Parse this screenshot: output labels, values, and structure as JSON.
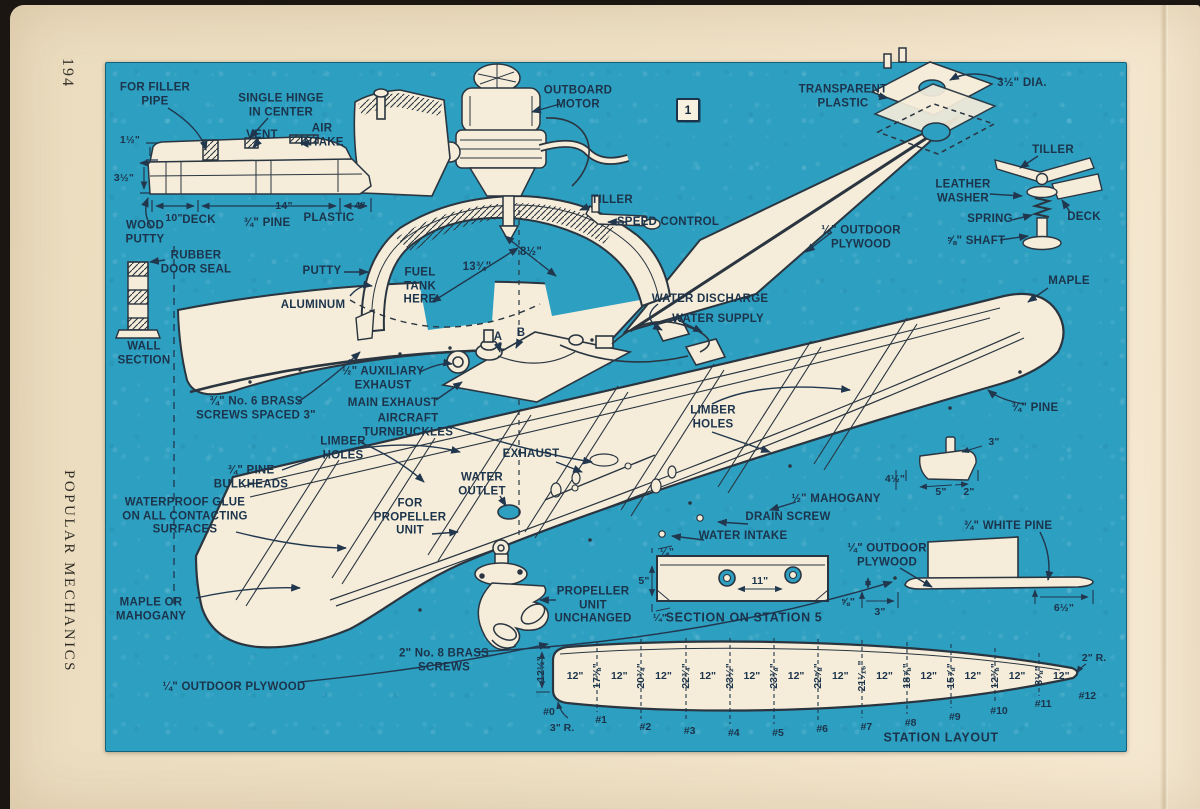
{
  "page": {
    "number": "194",
    "magazine": "POPULAR MECHANICS",
    "figure_badge": "1"
  },
  "colors": {
    "blueprint_blue": "#2d9fc1",
    "paper_cream": "#eee0c4",
    "ink_navy": "#1c344b",
    "drawing_white": "#f5edda",
    "line_dark": "#2a3540"
  },
  "labels": {
    "for_filler_pipe": "FOR FILLER\nPIPE",
    "single_hinge": "SINGLE HINGE\nIN CENTER",
    "vent": "VENT",
    "air_intake": "AIR\nINTAKE",
    "outboard_motor": "OUTBOARD\nMOTOR",
    "transparent_plastic": "TRANSPARENT\nPLASTIC",
    "dia_3_5": "3½\" DIA.",
    "tiller_right": "TILLER",
    "leather_washer": "LEATHER\nWASHER",
    "spring": "SPRING",
    "deck_right": "DECK",
    "shaft_5_8": "⅝\" SHAFT",
    "plywood_top_right": "¼\" OUTDOOR\nPLYWOOD",
    "maple": "MAPLE",
    "wood_putty": "WOOD\nPUTTY",
    "deck_left": "DECK",
    "pine_under_deck": "¾\" PINE",
    "plastic": "PLASTIC",
    "rubber_door_seal": "RUBBER\nDOOR SEAL",
    "wall_section": "WALL\nSECTION",
    "putty": "PUTTY",
    "aluminum": "ALUMINUM",
    "fuel_tank_here": "FUEL\nTANK\nHERE",
    "tiller_mid": "TILLER",
    "speed_control": "SPEED CONTROL",
    "water_discharge": "WATER DISCHARGE",
    "water_supply": "WATER SUPPLY",
    "point_a": "A",
    "point_b": "B",
    "aux_exhaust": "½\" AUXILIARY\nEXHAUST",
    "main_exhaust": "MAIN EXHAUST",
    "aircraft_turnbuckles": "AIRCRAFT\nTURNBUCKLES",
    "brass_screws_no6": "¾\" No. 6 BRASS\nSCREWS SPACED 3\"",
    "limber_holes_left": "LIMBER\nHOLES",
    "limber_holes_right": "LIMBER\nHOLES",
    "pine_bulkheads": "¾\" PINE\nBULKHEADS",
    "waterproof_glue": "WATERPROOF GLUE\nON ALL CONTACTING\nSURFACES",
    "maple_or_mahogany": "MAPLE OR\nMAHOGANY",
    "plywood_bottom_left": "¼\" OUTDOOR PLYWOOD",
    "brass_screws_no8": "2\" No. 8 BRASS\nSCREWS",
    "exhaust": "EXHAUST",
    "water_outlet": "WATER\nOUTLET",
    "for_propeller_unit": "FOR\nPROPELLER\nUNIT",
    "mahogany_half": "½\" MAHOGANY",
    "drain_screw": "DRAIN SCREW",
    "water_intake": "WATER INTAKE",
    "propeller_unit": "PROPELLER\nUNIT\nUNCHANGED",
    "pine_hull": "¾\" PINE",
    "white_pine": "¾\" WHITE PINE",
    "plywood_right": "¼\" OUTDOOR\nPLYWOOD",
    "section_station5": "SECTION ON STATION 5"
  },
  "dims": {
    "d1_5": "1½\"",
    "d3_5": "3½\"",
    "d10": "10\"",
    "d14": "14\"",
    "d4": "4\"",
    "d13_75": "13¾\"",
    "d8_5": "8½\"",
    "fin3": "3\"",
    "fin4_5": "4½\"",
    "fin5": "5\"",
    "fin2": "2\"",
    "secq_top": "¼\"",
    "sec5": "5\"",
    "sec11": "11\"",
    "secq_bot": "¼\"",
    "wp58": "⅝\"",
    "wp3": "3\"",
    "wp65": "6½\""
  },
  "station_layout": {
    "title": "STATION LAYOUT",
    "left_height": "12½\"",
    "left_radius": "3\" R.",
    "tip_radius": "2\" R.",
    "spacing": "12\"",
    "stations": [
      "#0",
      "#1",
      "#2",
      "#3",
      "#4",
      "#5",
      "#6",
      "#7",
      "#8",
      "#9",
      "#10",
      "#11",
      "#12"
    ],
    "half_breadths": [
      "17⅜\"",
      "20¾\"",
      "22¾\"",
      "23½\"",
      "23⅜\"",
      "22⅝\"",
      "21¹⁄₁₆\"",
      "18⅞\"",
      "15⅞\"",
      "12⅜\"",
      "8⅛\""
    ]
  }
}
